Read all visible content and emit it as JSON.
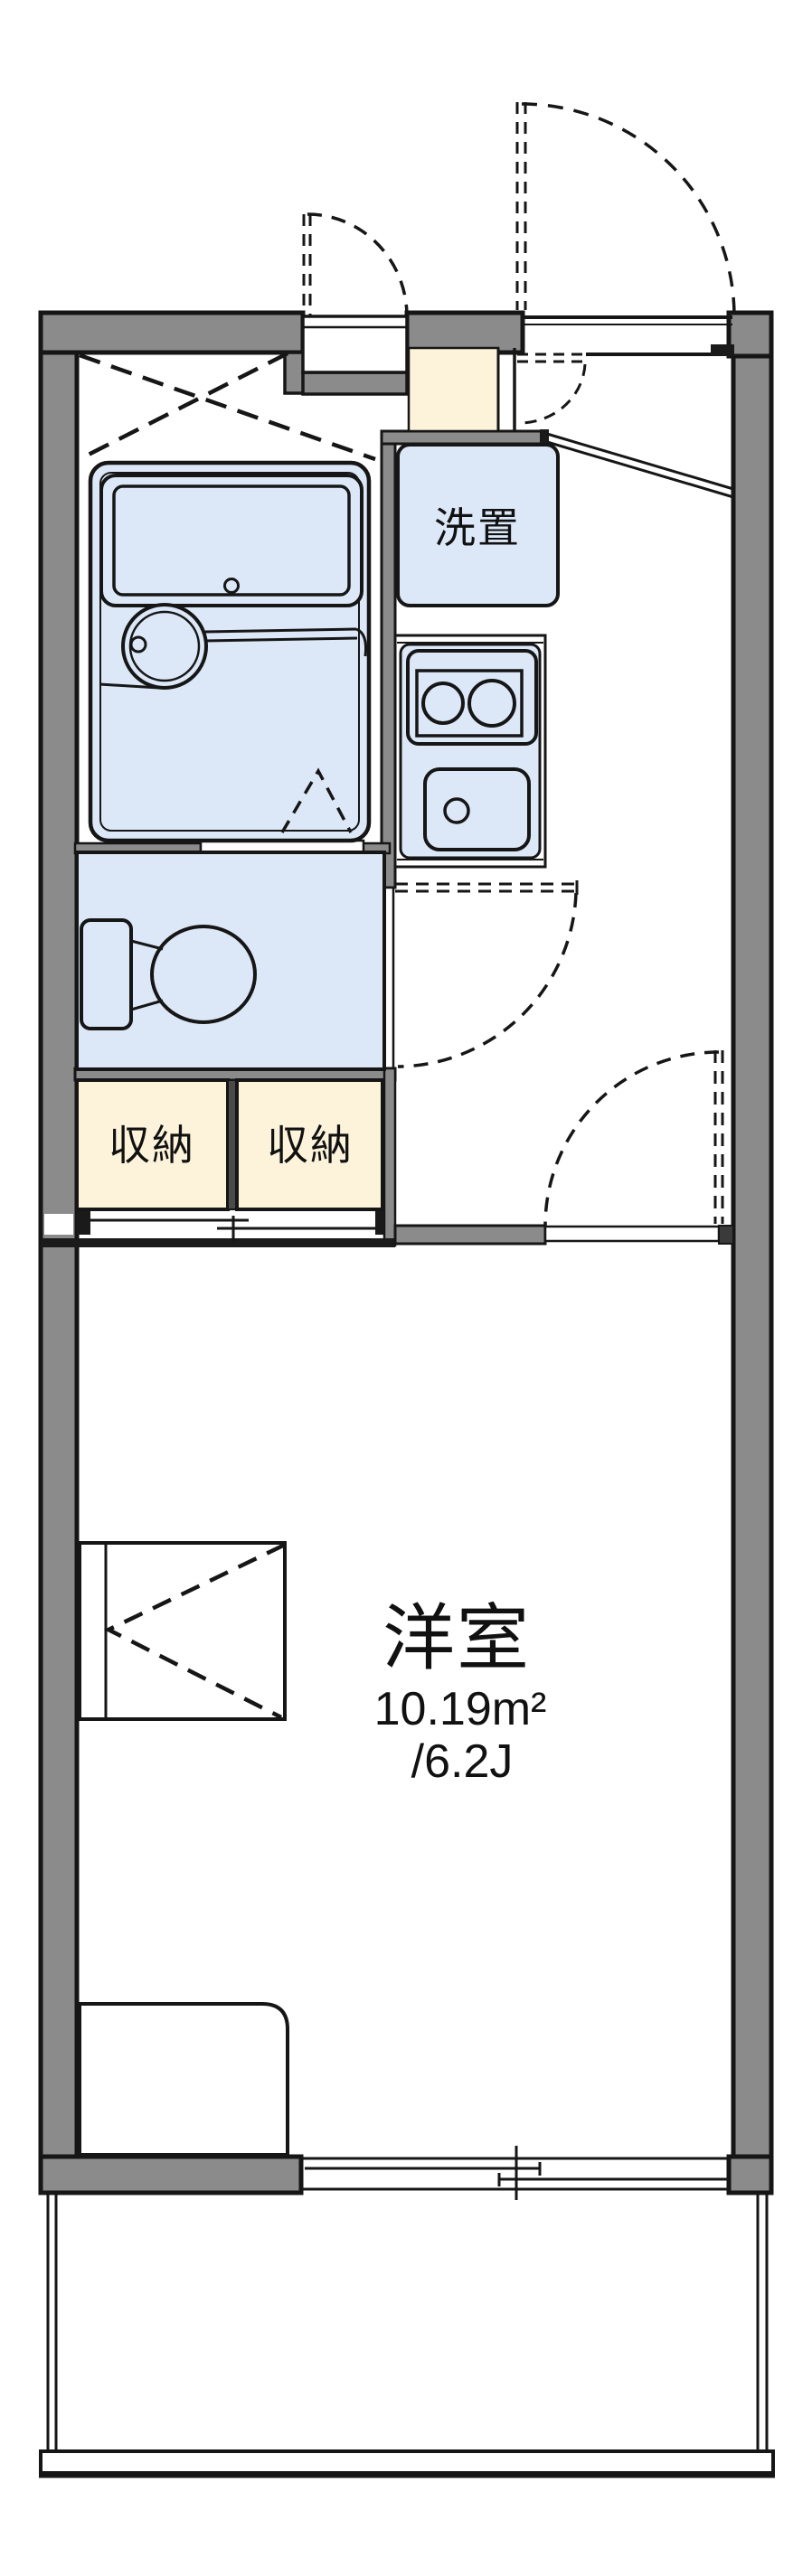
{
  "plan": {
    "type": "apartment-floor-plan",
    "labels": {
      "washer_space": "洗置",
      "storage_left": "収納",
      "storage_right": "収納",
      "room_name": "洋室",
      "room_area_m2": "10.19m²",
      "room_area_jo": "/6.2J"
    },
    "rooms": [
      {
        "name": "洋室",
        "area_m2": "10.19m²",
        "area_tatami": "/6.2J"
      },
      {
        "name": "収納",
        "count": 2
      },
      {
        "name": "洗置"
      }
    ],
    "colors": {
      "wall_gray": "#8b8b8b",
      "fixture_blue": "#dce8f8",
      "storage_beige": "#fcf3da",
      "line_black": "#161616",
      "background": "#ffffff"
    }
  }
}
